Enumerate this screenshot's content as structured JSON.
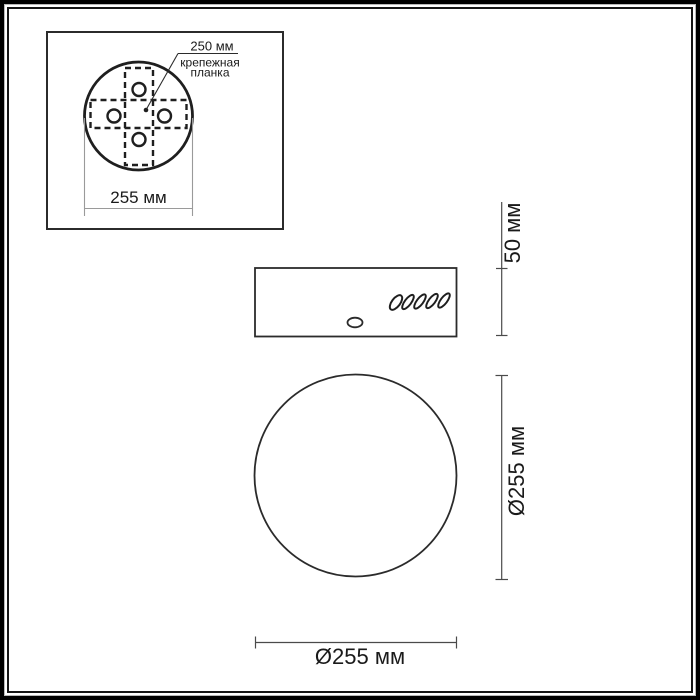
{
  "drawing": {
    "type": "technical-drawing",
    "subject": "round ceiling mounting base, three orthographic views"
  },
  "colors": {
    "background": "#ffffff",
    "line": "#2b2b2b",
    "text": "#1a1a1a",
    "frame": "#000000"
  },
  "top_view": {
    "pitch_label": "250 мм",
    "part_label_line1": "крепежная",
    "part_label_line2": "планка",
    "width_label": "255 мм"
  },
  "side_view": {
    "height_label": "50 мм"
  },
  "front_view": {
    "diameter_label_vertical": "Ø255 мм",
    "diameter_label_horizontal": "Ø255 мм"
  }
}
